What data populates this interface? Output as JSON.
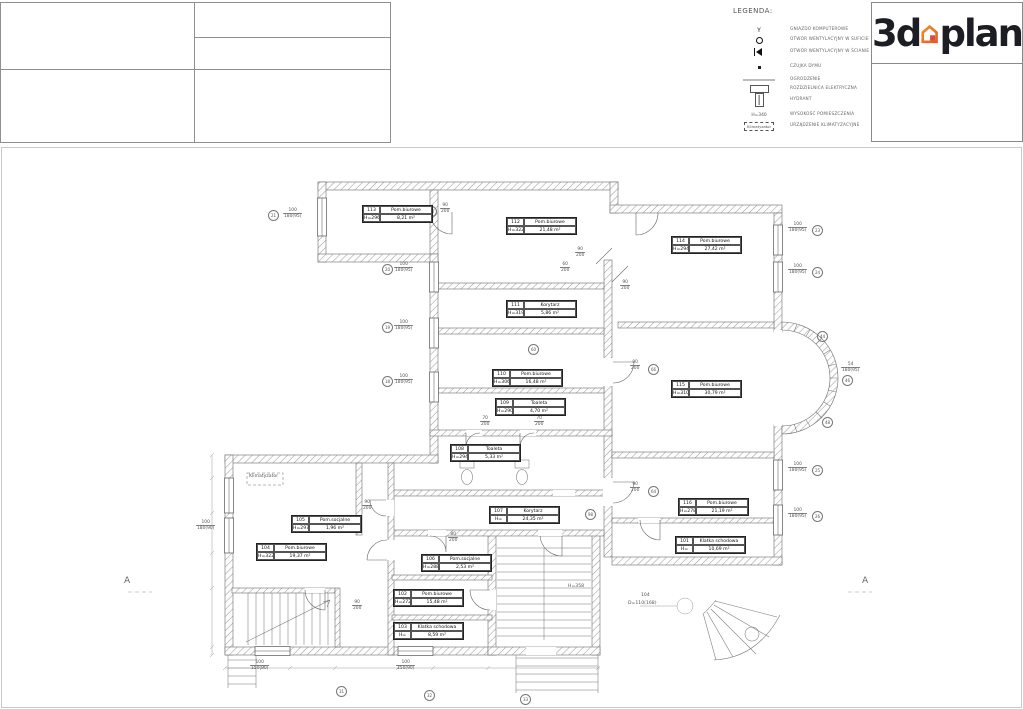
{
  "legend": {
    "title": "LEGENDA:",
    "items": [
      {
        "symbol": "computer-socket",
        "label": "GNIAZDO KOMPUTEROWE",
        "y": 22
      },
      {
        "symbol": "ceiling-vent",
        "label": "OTWÓR WENTYLACYJNY W SUFICIE",
        "y": 32
      },
      {
        "symbol": "wall-vent",
        "label": "OTWÓR WENTYLACYJNY W ŚCIANIE",
        "y": 44
      },
      {
        "symbol": "smoke-detector",
        "label": "CZUJKA DYMU",
        "y": 59
      },
      {
        "symbol": "gray-line",
        "label": "OGRODZENIE",
        "y": 72
      },
      {
        "symbol": "electrical-board",
        "label": "ROZDZIELNICA ELEKTRYCZNA",
        "y": 81
      },
      {
        "symbol": "hydrant",
        "label": "HYDRANT",
        "y": 92
      },
      {
        "symbol": "height-text",
        "symbol_text": "H=340",
        "label": "WYSOKOŚĆ POMIESZCZENIA",
        "y": 107
      },
      {
        "symbol": "ac-box",
        "symbol_text": "Klimatyzator",
        "label": "URZĄDZENIE KLIMATYZACYJNE",
        "y": 118
      }
    ]
  },
  "logo": {
    "text_left": "3d",
    "text_right": "plan",
    "text_color": "#1d1d25",
    "house_color": "#f6921e",
    "house_color_dark": "#e05a2b",
    "door_color": "#e2483d"
  },
  "rooms": [
    {
      "id": "113",
      "name": "Pom.biurowe",
      "h": "H=296",
      "area": "8,21 m²",
      "x": 362,
      "y": 205
    },
    {
      "id": "112",
      "name": "Pom.biurowe",
      "h": "H=322",
      "area": "21,48 m²",
      "x": 506,
      "y": 217
    },
    {
      "id": "114",
      "name": "Pom.biurowe",
      "h": "H=294",
      "area": "27,42 m²",
      "x": 671,
      "y": 236
    },
    {
      "id": "111",
      "name": "Korytarz",
      "h": "H=319",
      "area": "5,86 m²",
      "x": 506,
      "y": 300
    },
    {
      "id": "110",
      "name": "Pom.biurowe",
      "h": "H=306",
      "area": "16,48 m²",
      "x": 492,
      "y": 369
    },
    {
      "id": "109",
      "name": "Toaleta",
      "h": "H=290",
      "area": "4,70 m²",
      "x": 495,
      "y": 398
    },
    {
      "id": "108",
      "name": "Toaleta",
      "h": "H=294",
      "area": "5,33 m²",
      "x": 450,
      "y": 444
    },
    {
      "id": "115",
      "name": "Pom.biurowe",
      "h": "H=310",
      "area": "30,79 m²",
      "x": 671,
      "y": 380
    },
    {
      "id": "116",
      "name": "Pom.biurowe",
      "h": "H=278",
      "area": "21,19 m²",
      "x": 678,
      "y": 498
    },
    {
      "id": "101",
      "name": "Klatka schodowa",
      "h": "H=",
      "area": "10,69 m²",
      "x": 675,
      "y": 536
    },
    {
      "id": "107",
      "name": "Korytarz",
      "h": "H=",
      "area": "24,35 m²",
      "x": 489,
      "y": 506
    },
    {
      "id": "105",
      "name": "Pom.socjalne",
      "h": "H=297",
      "area": "1,96 m²",
      "x": 291,
      "y": 515
    },
    {
      "id": "104",
      "name": "Pom.biurowe",
      "h": "H=322",
      "area": "19,37 m²",
      "x": 256,
      "y": 543
    },
    {
      "id": "106",
      "name": "Pom.socjalne",
      "h": "H=288",
      "area": "2,53 m²",
      "x": 421,
      "y": 554
    },
    {
      "id": "102",
      "name": "Pom.biurowe",
      "h": "H=272",
      "area": "15,48 m²",
      "x": 393,
      "y": 589
    },
    {
      "id": "103",
      "name": "Klatka schodowa",
      "h": "H=",
      "area": "8,59 m²",
      "x": 393,
      "y": 622
    }
  ],
  "window_labels": [
    {
      "num": "100",
      "den": "180(95)",
      "x": 283,
      "y": 208
    },
    {
      "num": "100",
      "den": "180(95)",
      "x": 394,
      "y": 262
    },
    {
      "num": "100",
      "den": "180(95)",
      "x": 394,
      "y": 320
    },
    {
      "num": "100",
      "den": "180(95)",
      "x": 394,
      "y": 374
    },
    {
      "num": "100",
      "den": "180(95)",
      "x": 788,
      "y": 222
    },
    {
      "num": "100",
      "den": "180(95)",
      "x": 788,
      "y": 264
    },
    {
      "num": "100",
      "den": "180(95)",
      "x": 788,
      "y": 462
    },
    {
      "num": "100",
      "den": "180(95)",
      "x": 788,
      "y": 508
    },
    {
      "num": "100",
      "den": "180(90)",
      "x": 196,
      "y": 520
    },
    {
      "num": "100",
      "den": "150(90)",
      "x": 250,
      "y": 660
    },
    {
      "num": "100",
      "den": "150(90)",
      "x": 396,
      "y": 660
    },
    {
      "num": "54",
      "den": "180(95)",
      "x": 841,
      "y": 362
    }
  ],
  "door_labels": [
    {
      "num": "90",
      "den": "200",
      "x": 440,
      "y": 203
    },
    {
      "num": "90",
      "den": "200",
      "x": 575,
      "y": 247
    },
    {
      "num": "60",
      "den": "200",
      "x": 560,
      "y": 262
    },
    {
      "num": "90",
      "den": "200",
      "x": 620,
      "y": 280
    },
    {
      "num": "90",
      "den": "200",
      "x": 630,
      "y": 360
    },
    {
      "num": "90",
      "den": "200",
      "x": 630,
      "y": 482
    },
    {
      "num": "70",
      "den": "200",
      "x": 534,
      "y": 416
    },
    {
      "num": "70",
      "den": "200",
      "x": 480,
      "y": 416
    },
    {
      "num": "90",
      "den": "200",
      "x": 362,
      "y": 500
    },
    {
      "num": "80",
      "den": "200",
      "x": 448,
      "y": 532
    },
    {
      "num": "90",
      "den": "200",
      "x": 352,
      "y": 600
    }
  ],
  "markers": [
    {
      "n": "36",
      "x": 426,
      "y": 206
    },
    {
      "n": "21",
      "x": 268,
      "y": 210
    },
    {
      "n": "20",
      "x": 382,
      "y": 264
    },
    {
      "n": "19",
      "x": 382,
      "y": 322
    },
    {
      "n": "18",
      "x": 382,
      "y": 376
    },
    {
      "n": "23",
      "x": 812,
      "y": 225
    },
    {
      "n": "24",
      "x": 812,
      "y": 267
    },
    {
      "n": "25",
      "x": 812,
      "y": 465
    },
    {
      "n": "26",
      "x": 812,
      "y": 511
    },
    {
      "n": "60",
      "x": 528,
      "y": 344
    },
    {
      "n": "66",
      "x": 648,
      "y": 364
    },
    {
      "n": "64",
      "x": 648,
      "y": 486
    },
    {
      "n": "98",
      "x": 585,
      "y": 509
    },
    {
      "n": "44",
      "x": 817,
      "y": 331
    },
    {
      "n": "46",
      "x": 842,
      "y": 375
    },
    {
      "n": "48",
      "x": 822,
      "y": 417
    },
    {
      "n": "31",
      "x": 336,
      "y": 686
    },
    {
      "n": "32",
      "x": 424,
      "y": 690
    },
    {
      "n": "33",
      "x": 520,
      "y": 694
    }
  ],
  "section_marks": [
    {
      "label": "A",
      "x": 124,
      "y": 576
    },
    {
      "label": "A",
      "x": 862,
      "y": 576
    }
  ],
  "notes": [
    {
      "text": "H=358",
      "x": 568,
      "y": 584
    },
    {
      "text": "104",
      "x": 641,
      "y": 593
    },
    {
      "text": "D=110(168)",
      "x": 628,
      "y": 601
    },
    {
      "text": "Klimatyzator",
      "x": 249,
      "y": 474
    }
  ]
}
